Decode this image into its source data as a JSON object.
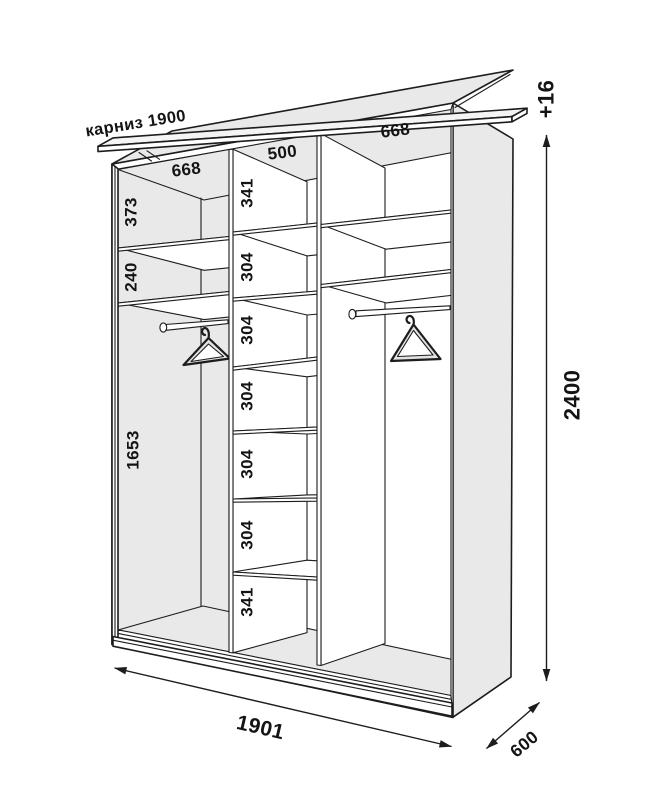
{
  "labels": {
    "cornice": "карниз 1900",
    "plus_height": "+16",
    "height": "2400",
    "width": "1901",
    "depth": "600",
    "section_widths": [
      "668",
      "500",
      "668"
    ],
    "left_sections": [
      "373",
      "240",
      "1653"
    ],
    "center_sections": [
      "341",
      "304",
      "304",
      "304",
      "304",
      "304",
      "341"
    ]
  },
  "colors": {
    "line": "#1d1d1d",
    "panel_gray": "#e9e9e9",
    "cornice_gray": "#f4f4f4",
    "background": "#ffffff",
    "text": "#141414"
  }
}
